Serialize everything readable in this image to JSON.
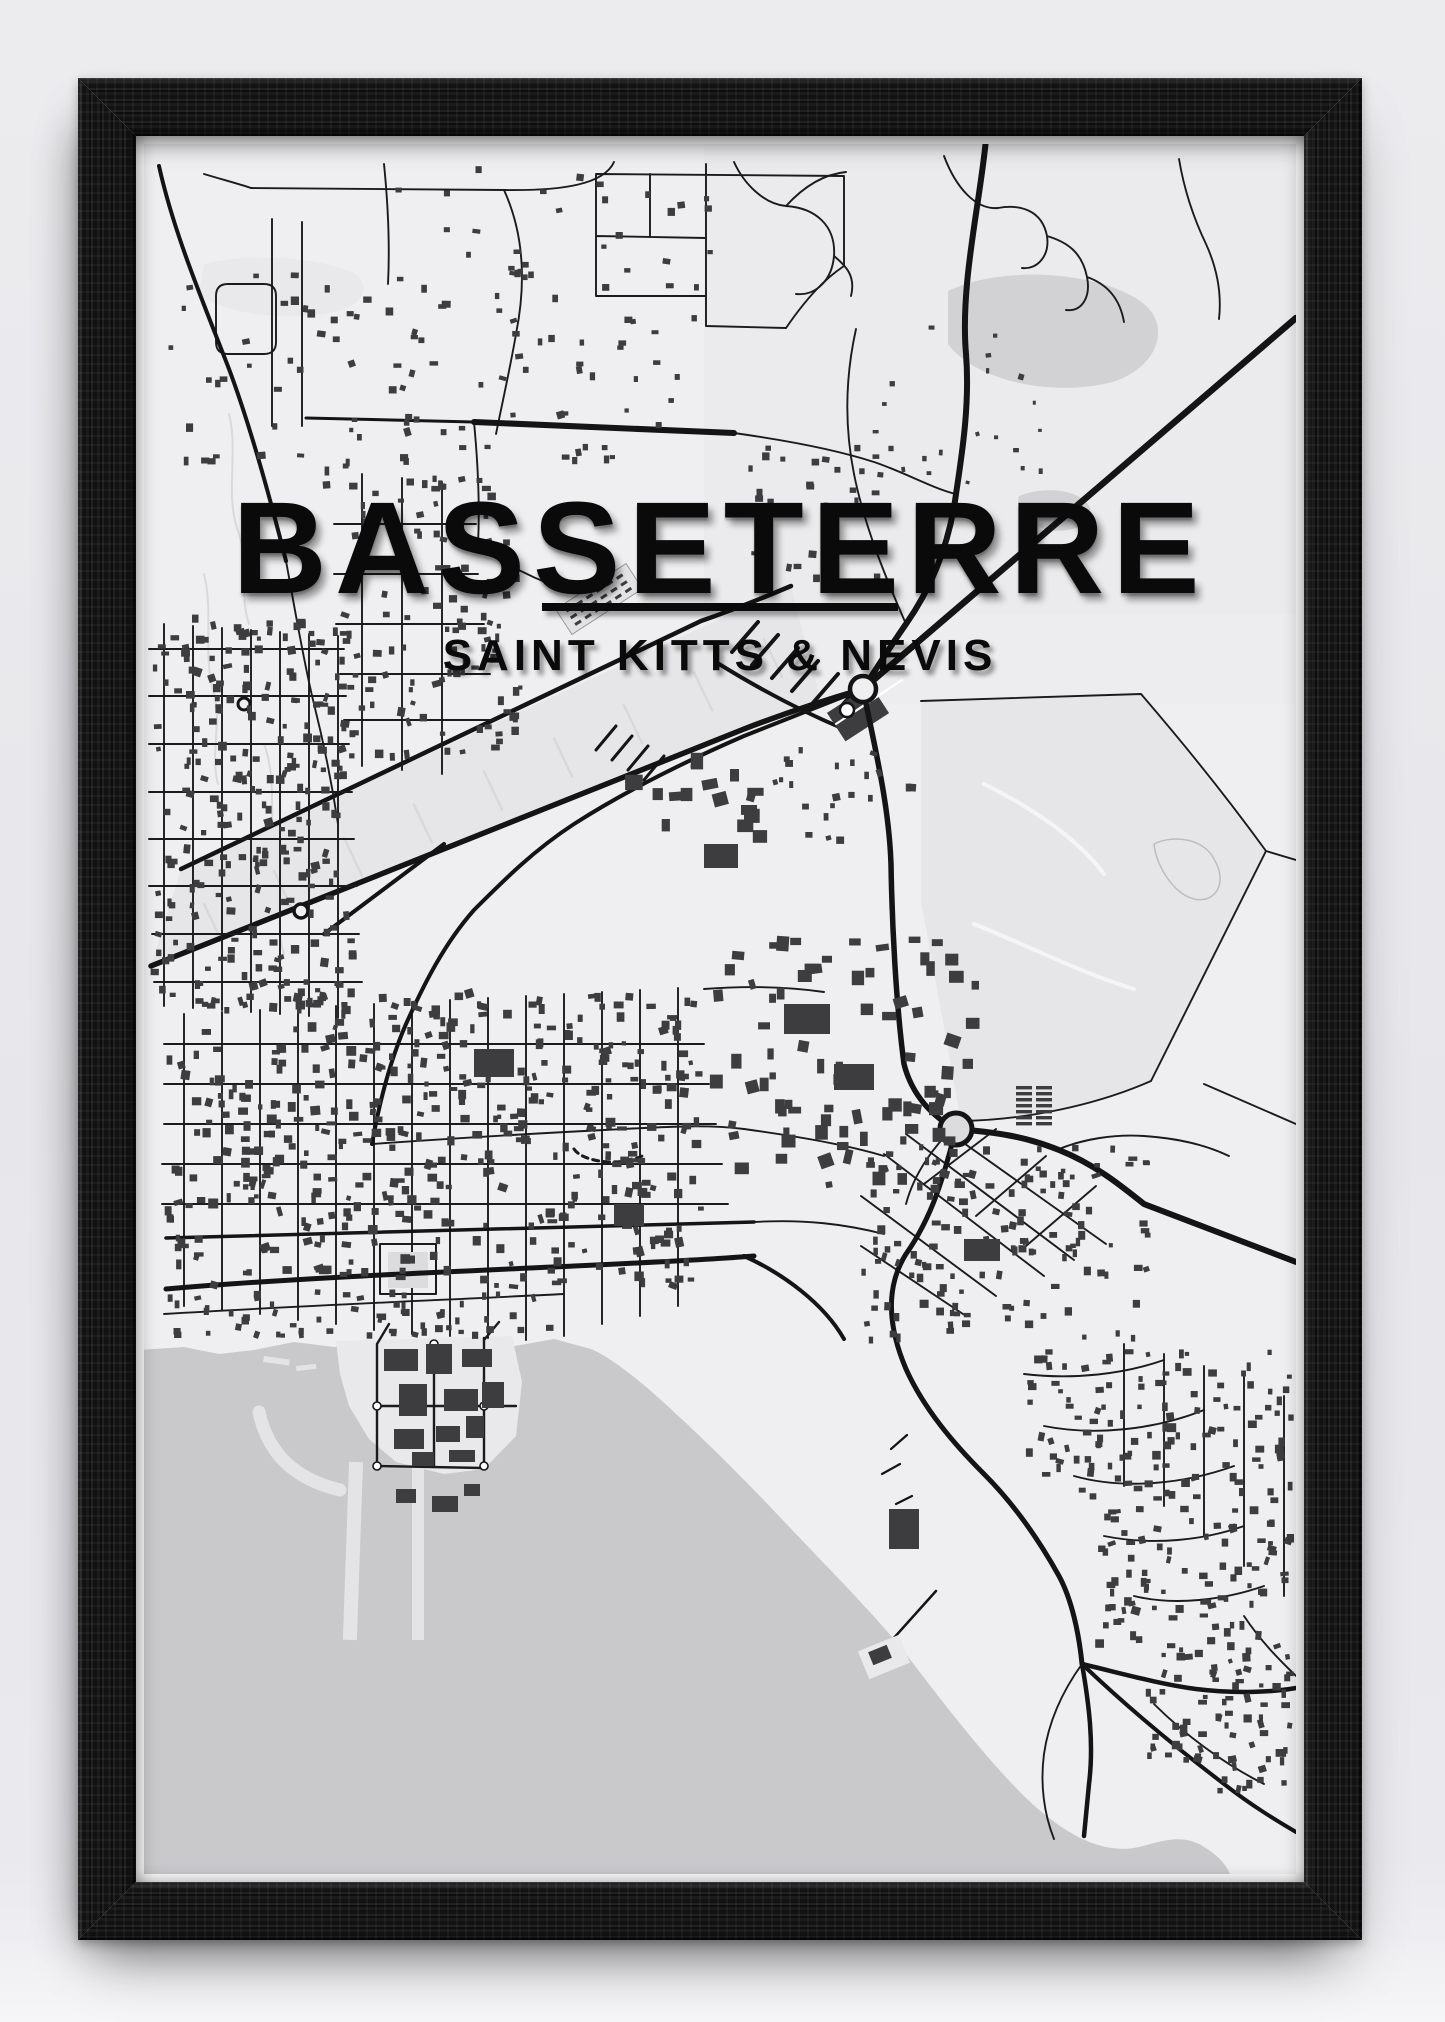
{
  "poster": {
    "title": "BASSETERRE",
    "subtitle": "SAINT KITTS & NEVIS"
  },
  "map": {
    "city": "Basseterre",
    "country": "Saint Kitts & Nevis",
    "features": [
      "street-network",
      "building-footprints",
      "airport-corridor",
      "port-zante-peninsula",
      "marina-piers",
      "breakwater",
      "roundabouts",
      "basseterre-bay",
      "independence-square",
      "east-pond",
      "coastline"
    ]
  },
  "colors": {
    "wall": "#e9e9ed",
    "frame_wood": "#171717",
    "paper": "#fcfcfd",
    "map_bg": "#efeff1",
    "map_bg_east": "#ebebed",
    "field": "#e6e6e9",
    "pond": "#d2d2d5",
    "water": "#c9c9cc",
    "reclaimed_land": "#e9e9eb",
    "pier": "#e4e4e7",
    "building": "#3d3d40",
    "road": "#141414",
    "minor_road": "#1b1b1d",
    "contour": "#d9d9db",
    "square": "#dcdcdf",
    "title_text": "#0a0a0a"
  }
}
